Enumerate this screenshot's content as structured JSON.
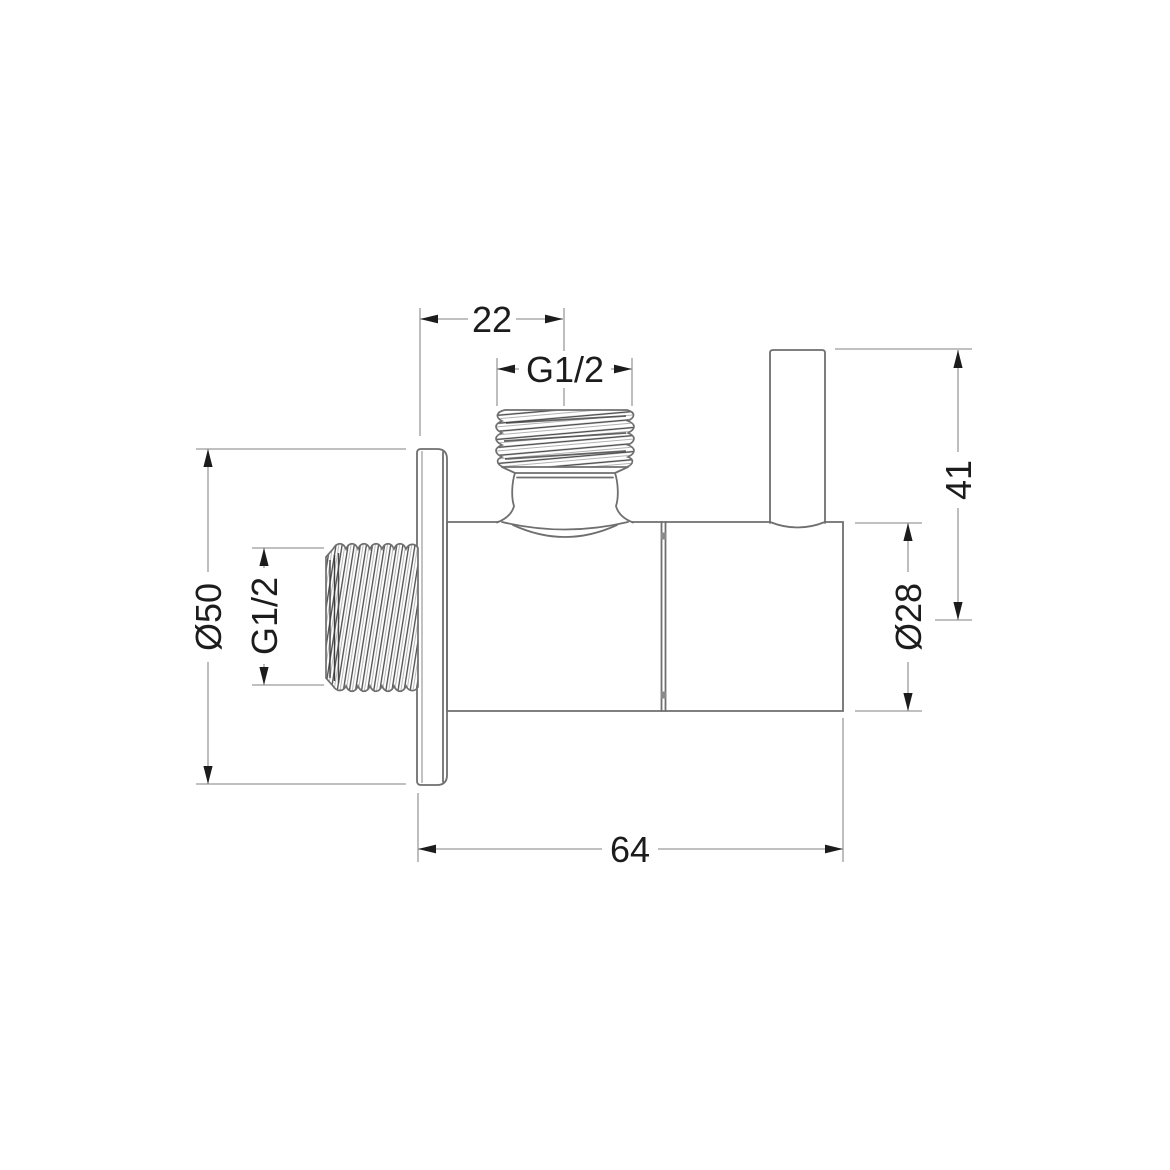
{
  "drawing": {
    "type": "technical-dimension-drawing",
    "subject": "angle-valve-side-view",
    "background_color": "#ffffff",
    "line_color": "#6f6f6f",
    "dimension_line_color": "#9b9b9b",
    "text_color": "#1c1c1c",
    "dims": {
      "top_offset": "22",
      "top_thread": "G1/2",
      "left_thread": "G1/2",
      "flange_diameter": "Ø50",
      "body_diameter": "Ø28",
      "height": "41",
      "length": "64"
    }
  }
}
